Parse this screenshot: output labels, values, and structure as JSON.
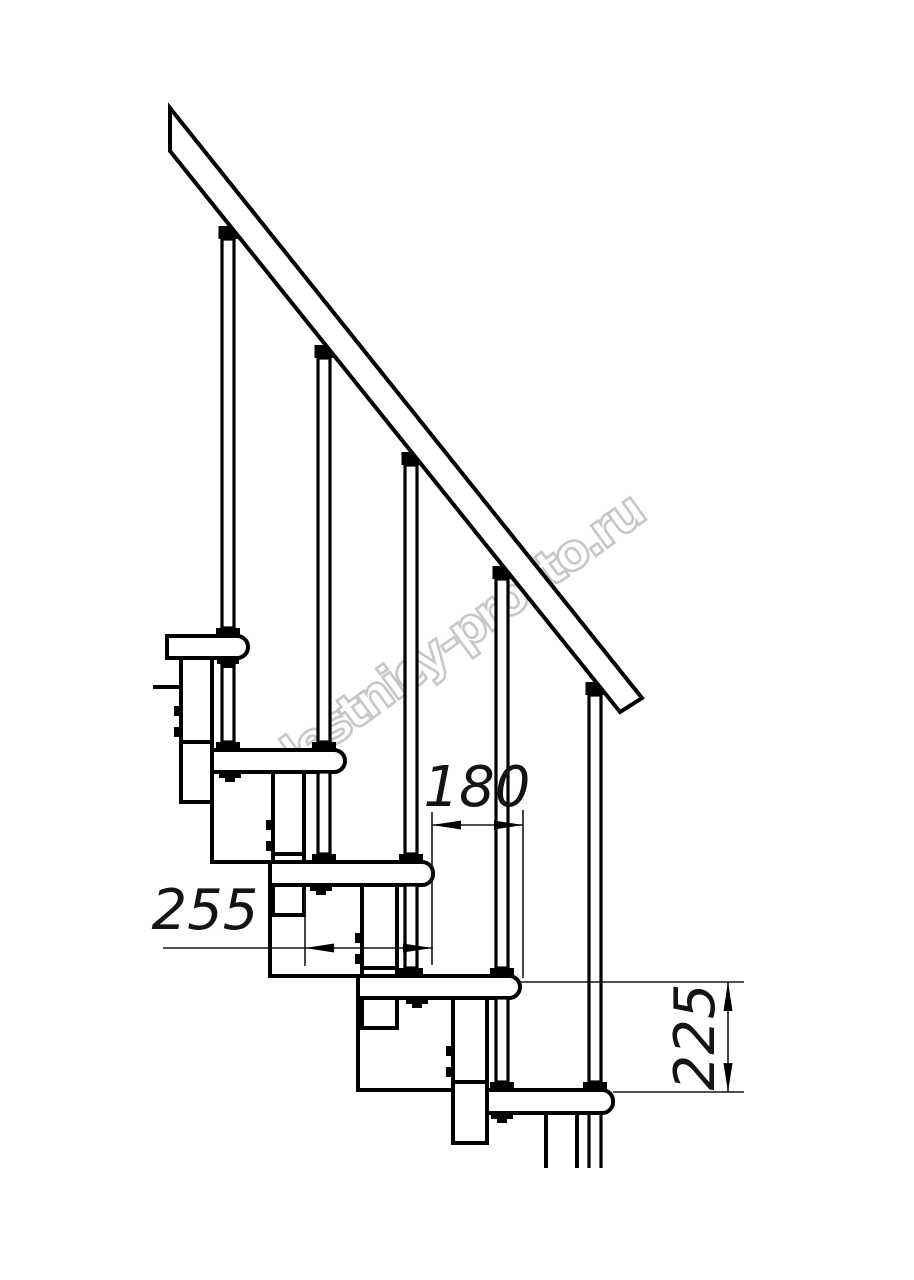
{
  "watermark": {
    "text": "lestnicy-prosto.ru",
    "color": "#c7c7c7"
  },
  "drawing": {
    "type": "technical-line-drawing",
    "subject": "modular staircase side elevation with handrail",
    "steps_visible": 5,
    "balusters_visible": 5,
    "line_color": "#000000",
    "background": "#ffffff",
    "dimensions": [
      {
        "id": "step-run",
        "value": "180",
        "orientation": "horizontal"
      },
      {
        "id": "tread-depth",
        "value": "255",
        "orientation": "horizontal"
      },
      {
        "id": "step-rise",
        "value": "225",
        "orientation": "vertical"
      }
    ]
  }
}
